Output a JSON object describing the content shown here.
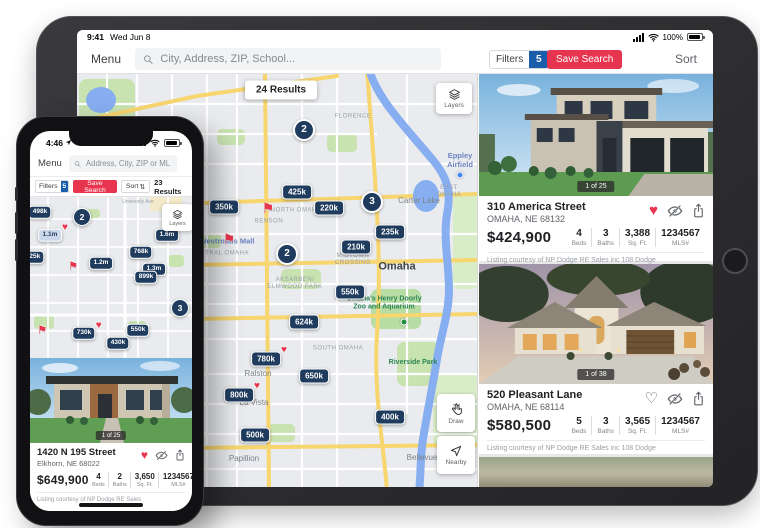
{
  "icons": {
    "heart_filled": "♥",
    "heart_outline": "♡",
    "flag": "⚑",
    "sort_arrows": "⇅"
  },
  "colors": {
    "pin_navy": "#1f3c5e",
    "accent_red": "#e8354f",
    "badge_blue": "#1a5dab",
    "map_water": "#86aef0",
    "map_park": "#c8e2b0",
    "map_highway_yellow": "#f7d56f"
  },
  "ipad": {
    "status_bar": {
      "time": "9:41",
      "date": "Wed Jun 8",
      "battery": "100%"
    },
    "toolbar": {
      "menu": "Menu",
      "search_placeholder": "City, Address, ZIP, School...",
      "filters_label": "Filters",
      "filters_count": "5",
      "save_search": "Save Search",
      "sort": "Sort"
    },
    "map": {
      "results_badge": "24 Results",
      "layers_label": "Layers",
      "draw_label": "Draw",
      "nearby_label": "Nearby",
      "pins": [
        {
          "type": "cluster",
          "label": "2",
          "x": 227,
          "y": 56
        },
        {
          "type": "price",
          "label": "425k",
          "x": 220,
          "y": 118
        },
        {
          "type": "price",
          "label": "350k",
          "x": 147,
          "y": 133
        },
        {
          "type": "flag",
          "x": 191,
          "y": 134
        },
        {
          "type": "price",
          "label": "220k",
          "x": 252,
          "y": 134
        },
        {
          "type": "cluster",
          "label": "3",
          "x": 295,
          "y": 128
        },
        {
          "type": "price",
          "label": "235k",
          "x": 313,
          "y": 158
        },
        {
          "type": "flag",
          "x": 152,
          "y": 165
        },
        {
          "type": "price",
          "label": "210k",
          "x": 279,
          "y": 173
        },
        {
          "type": "cluster",
          "label": "2",
          "x": 210,
          "y": 180
        },
        {
          "type": "price",
          "label": "550k",
          "x": 273,
          "y": 218
        },
        {
          "type": "price",
          "label": "624k",
          "x": 227,
          "y": 248
        },
        {
          "type": "price",
          "label": "780k",
          "x": 189,
          "y": 285,
          "heart": true
        },
        {
          "type": "price",
          "label": "650k",
          "x": 237,
          "y": 302
        },
        {
          "type": "price",
          "label": "800k",
          "x": 162,
          "y": 321,
          "heart": true
        },
        {
          "type": "price",
          "label": "400k",
          "x": 313,
          "y": 343
        },
        {
          "type": "price",
          "label": "500k",
          "x": 178,
          "y": 361
        }
      ],
      "labels": [
        {
          "text": "FLORENCE",
          "cls": "tiny",
          "x": 276,
          "y": 43
        },
        {
          "text": "Eppley\nAirfield",
          "cls": "blue",
          "x": 383,
          "y": 86
        },
        {
          "text": "",
          "cls": "dot-blue",
          "x": 383,
          "y": 101
        },
        {
          "text": "EAST OMAHA",
          "cls": "tiny",
          "x": 372,
          "y": 118
        },
        {
          "text": "Carter Lake",
          "cls": "town",
          "x": 342,
          "y": 127
        },
        {
          "text": "NORTH OMAHA",
          "cls": "tiny",
          "x": 219,
          "y": 137
        },
        {
          "text": "BENSON",
          "cls": "tiny",
          "x": 192,
          "y": 148
        },
        {
          "text": "",
          "cls": "dot-blue",
          "x": 118,
          "y": 167
        },
        {
          "text": "Westroads Mall",
          "cls": "blue",
          "x": 150,
          "y": 167
        },
        {
          "text": "CENTRAL OMAHA",
          "cls": "tiny",
          "x": 143,
          "y": 180
        },
        {
          "text": "MIDTOWN\nCROSSING",
          "cls": "tiny",
          "x": 276,
          "y": 186
        },
        {
          "text": "Omaha",
          "cls": "city",
          "x": 320,
          "y": 193
        },
        {
          "text": "AKSARBEN/\nELMWOOD PARK",
          "cls": "tiny",
          "x": 218,
          "y": 210
        },
        {
          "text": "Omaha's Henry Doorly\nZoo and Aquarium",
          "cls": "green",
          "x": 307,
          "y": 230
        },
        {
          "text": "",
          "cls": "dot-green",
          "x": 327,
          "y": 248
        },
        {
          "text": "SOUTH OMAHA",
          "cls": "tiny",
          "x": 261,
          "y": 275
        },
        {
          "text": "Riverside Park",
          "cls": "green",
          "x": 336,
          "y": 289
        },
        {
          "text": "Ralston",
          "cls": "town",
          "x": 181,
          "y": 300
        },
        {
          "text": "La Vista",
          "cls": "town",
          "x": 177,
          "y": 329
        },
        {
          "text": "Papillion",
          "cls": "town",
          "x": 167,
          "y": 385
        },
        {
          "text": "Bellevue",
          "cls": "town",
          "x": 345,
          "y": 384
        }
      ]
    },
    "cards": [
      {
        "photo_counter": "1 of 25",
        "address": "310 America Street",
        "city": "OMAHA, NE 68132",
        "price": "$424,900",
        "stats": [
          {
            "value": "4",
            "label": "Beds"
          },
          {
            "value": "3",
            "label": "Baths"
          },
          {
            "value": "3,388",
            "label": "Sq. Ft."
          },
          {
            "value": "1234567",
            "label": "MLS#"
          }
        ],
        "courtesy": "Listing courtesy of NP Dodge RE Sales inc 108 Dodge"
      },
      {
        "photo_counter": "1 of 38",
        "address": "520 Pleasant Lane",
        "city": "OMAHA, NE 68114",
        "price": "$580,500",
        "stats": [
          {
            "value": "5",
            "label": "Beds"
          },
          {
            "value": "3",
            "label": "Baths"
          },
          {
            "value": "3,565",
            "label": "Sq. Ft."
          },
          {
            "value": "1234567",
            "label": "MLS#"
          }
        ],
        "courtesy": "Listing courtesy of NP Dodge RE Sales inc 108 Dodge"
      }
    ]
  },
  "iphone": {
    "status_bar": {
      "time": "4:46"
    },
    "toolbar": {
      "menu": "Menu",
      "search_placeholder": "Address, City, ZIP or MLS"
    },
    "filter_row": {
      "filters_label": "Filters",
      "filters_count": "5",
      "save_search": "Save Search",
      "sort": "Sort",
      "results": "23 Results"
    },
    "map": {
      "layers_label": "Layers",
      "pins": [
        {
          "type": "price",
          "label": "498k",
          "x": 10,
          "y": 15
        },
        {
          "type": "cluster",
          "label": "2",
          "x": 52,
          "y": 20
        },
        {
          "type": "price-light",
          "label": "1.1m",
          "x": 20,
          "y": 38,
          "heart": true
        },
        {
          "type": "price",
          "label": "1.6m",
          "x": 137,
          "y": 38
        },
        {
          "type": "price",
          "label": "525k",
          "x": 3,
          "y": 60
        },
        {
          "type": "price",
          "label": "768k",
          "x": 111,
          "y": 55
        },
        {
          "type": "price",
          "label": "1.2m",
          "x": 71,
          "y": 66
        },
        {
          "type": "flag",
          "x": 43,
          "y": 70
        },
        {
          "type": "price",
          "label": "1.3m",
          "x": 124,
          "y": 72
        },
        {
          "type": "price",
          "label": "899k",
          "x": 116,
          "y": 80
        },
        {
          "type": "cluster",
          "label": "3",
          "x": 150,
          "y": 111
        },
        {
          "type": "flag",
          "x": 12,
          "y": 134
        },
        {
          "type": "price",
          "label": "730k",
          "x": 54,
          "y": 136,
          "heart": true
        },
        {
          "type": "price",
          "label": "550k",
          "x": 108,
          "y": 133
        },
        {
          "type": "price",
          "label": "430k",
          "x": 88,
          "y": 146
        }
      ],
      "labels": [
        {
          "text": "University Ave",
          "cls": "road",
          "x": 108,
          "y": 5
        }
      ]
    },
    "card": {
      "photo_counter": "1 of 25",
      "address": "1420 N 195 Street",
      "city": "Elkhorn, NE 68022",
      "price": "$649,900",
      "stats": [
        {
          "value": "4",
          "label": "Beds"
        },
        {
          "value": "2",
          "label": "Baths"
        },
        {
          "value": "3,650",
          "label": "Sq. Ft."
        },
        {
          "value": "1234567",
          "label": "MLS#"
        }
      ],
      "courtesy": "Listing courtesy of NP Dodge RE Sales"
    }
  }
}
